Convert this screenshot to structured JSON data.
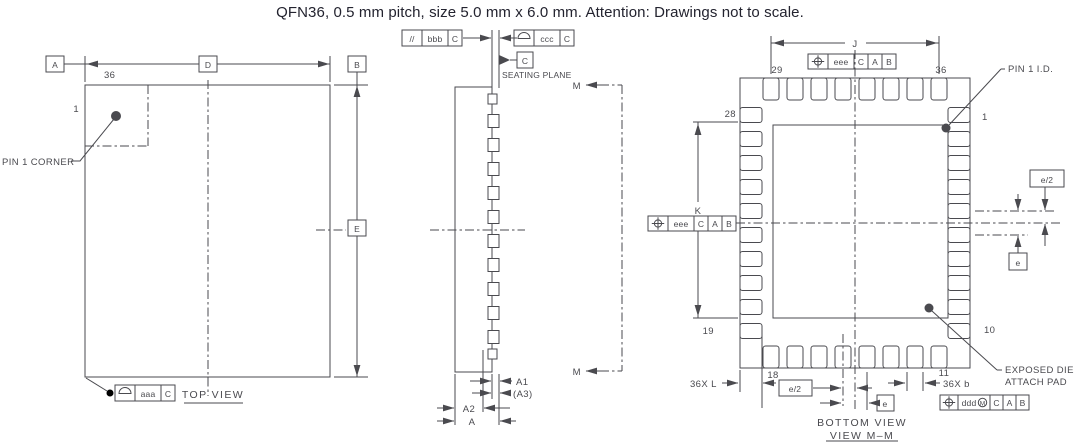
{
  "title": "QFN36, 0.5 mm pitch, size 5.0 mm x 6.0 mm. Attention: Drawings not to scale.",
  "colors": {
    "background": "#ffffff",
    "line": "#4a4a4f",
    "text": "#4a4a4f",
    "title_text": "#23232f"
  },
  "top_view": {
    "caption": "TOP VIEW",
    "pin_count": "36",
    "pin_one": "1",
    "pin1_corner_label": "PIN 1 CORNER",
    "datum_a": "A",
    "datum_b": "B",
    "dim_d": "D",
    "dim_e": "E",
    "fcf_aaa": {
      "symbol_icon": "profile-of-surface",
      "tolerance": "aaa",
      "datum": "C"
    }
  },
  "side_view": {
    "seating_plane_label": "SEATING PLANE",
    "datum_c": "C",
    "section_label": "M",
    "dim_a1": "A1",
    "dim_a3": "(A3)",
    "dim_a2": "A2",
    "dim_a": "A",
    "fcf_bbb": {
      "symbol": "//",
      "tolerance": "bbb",
      "datum": "C"
    },
    "fcf_ccc": {
      "symbol_icon": "profile-of-surface",
      "tolerance": "ccc",
      "datum": "C"
    }
  },
  "bottom_view": {
    "caption": "BOTTOM VIEW",
    "caption2": "VIEW M–M",
    "dim_j": "J",
    "dim_k": "K",
    "dim_l": "36X L",
    "dim_b": "36X b",
    "dim_e": "e",
    "dim_e_half": "e/2",
    "pin1_id_label": "PIN 1 I.D.",
    "exposed_pad_line1": "EXPOSED DIE",
    "exposed_pad_line2": "ATTACH PAD",
    "pins": {
      "p1": "1",
      "p10": "10",
      "p11": "11",
      "p18": "18",
      "p19": "19",
      "p28": "28",
      "p29": "29",
      "p36": "36"
    },
    "fcf_eee": {
      "symbol_icon": "true-position",
      "tolerance": "eee",
      "d1": "C",
      "d2": "A",
      "d3": "B"
    },
    "fcf_ddd": {
      "symbol_icon": "true-position",
      "tolerance": "ddd",
      "modifier": "M",
      "d1": "C",
      "d2": "A",
      "d3": "B"
    }
  }
}
